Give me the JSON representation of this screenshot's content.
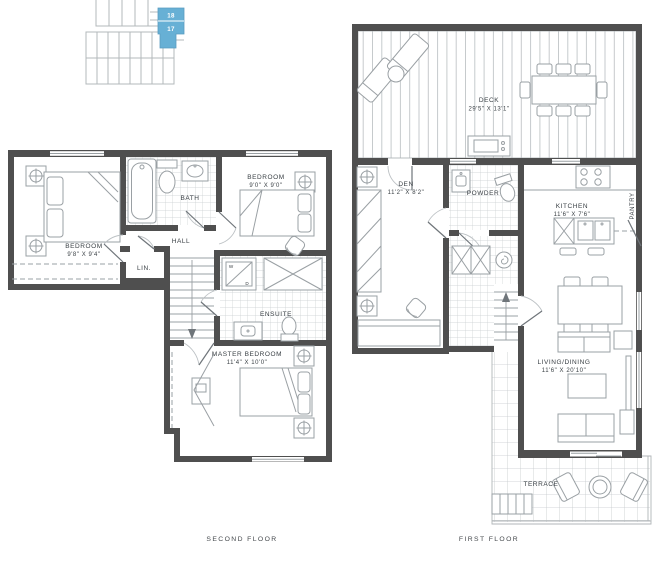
{
  "colors": {
    "wall": "#4f4f4f",
    "fixture_line": "#9aa0a4",
    "tile_line": "#c9cdd0",
    "plank_line": "#b8bdc0",
    "label_text": "#3a4045",
    "key_plan_line": "#b3b8bb",
    "unit_highlight": "#67b0d5",
    "unit_number_text": "#ffffff"
  },
  "key_plan": {
    "units": [
      {
        "number": "18"
      },
      {
        "number": "17"
      }
    ]
  },
  "second_floor": {
    "caption": "SECOND FLOOR",
    "bedroom1": {
      "name": "BEDROOM",
      "dims": "9'8\" X 9'4\""
    },
    "bath": {
      "name": "BATH"
    },
    "bedroom2": {
      "name": "BEDROOM",
      "dims": "9'0\" X 9'0\""
    },
    "hall": {
      "name": "HALL"
    },
    "linen": {
      "name": "LIN."
    },
    "ensuite": {
      "name": "ENSUITE"
    },
    "washer": {
      "label": "W"
    },
    "dryer": {
      "label": "D"
    },
    "master": {
      "name": "MASTER BEDROOM",
      "dims": "11'4\" X 10'0\""
    }
  },
  "first_floor": {
    "caption": "FIRST FLOOR",
    "deck": {
      "name": "DECK",
      "dims": "29'5\" X 13'1\""
    },
    "den": {
      "name": "DEN",
      "dims": "11'2\" X 8'2\""
    },
    "powder": {
      "name": "POWDER"
    },
    "kitchen": {
      "name": "KITCHEN",
      "dims": "11'6\" X 7'6\""
    },
    "pantry": {
      "name": "PANTRY"
    },
    "living_dining": {
      "name": "LIVING/DINING",
      "dims": "11'6\" X 20'10\""
    },
    "terrace": {
      "name": "TERRACE"
    }
  }
}
